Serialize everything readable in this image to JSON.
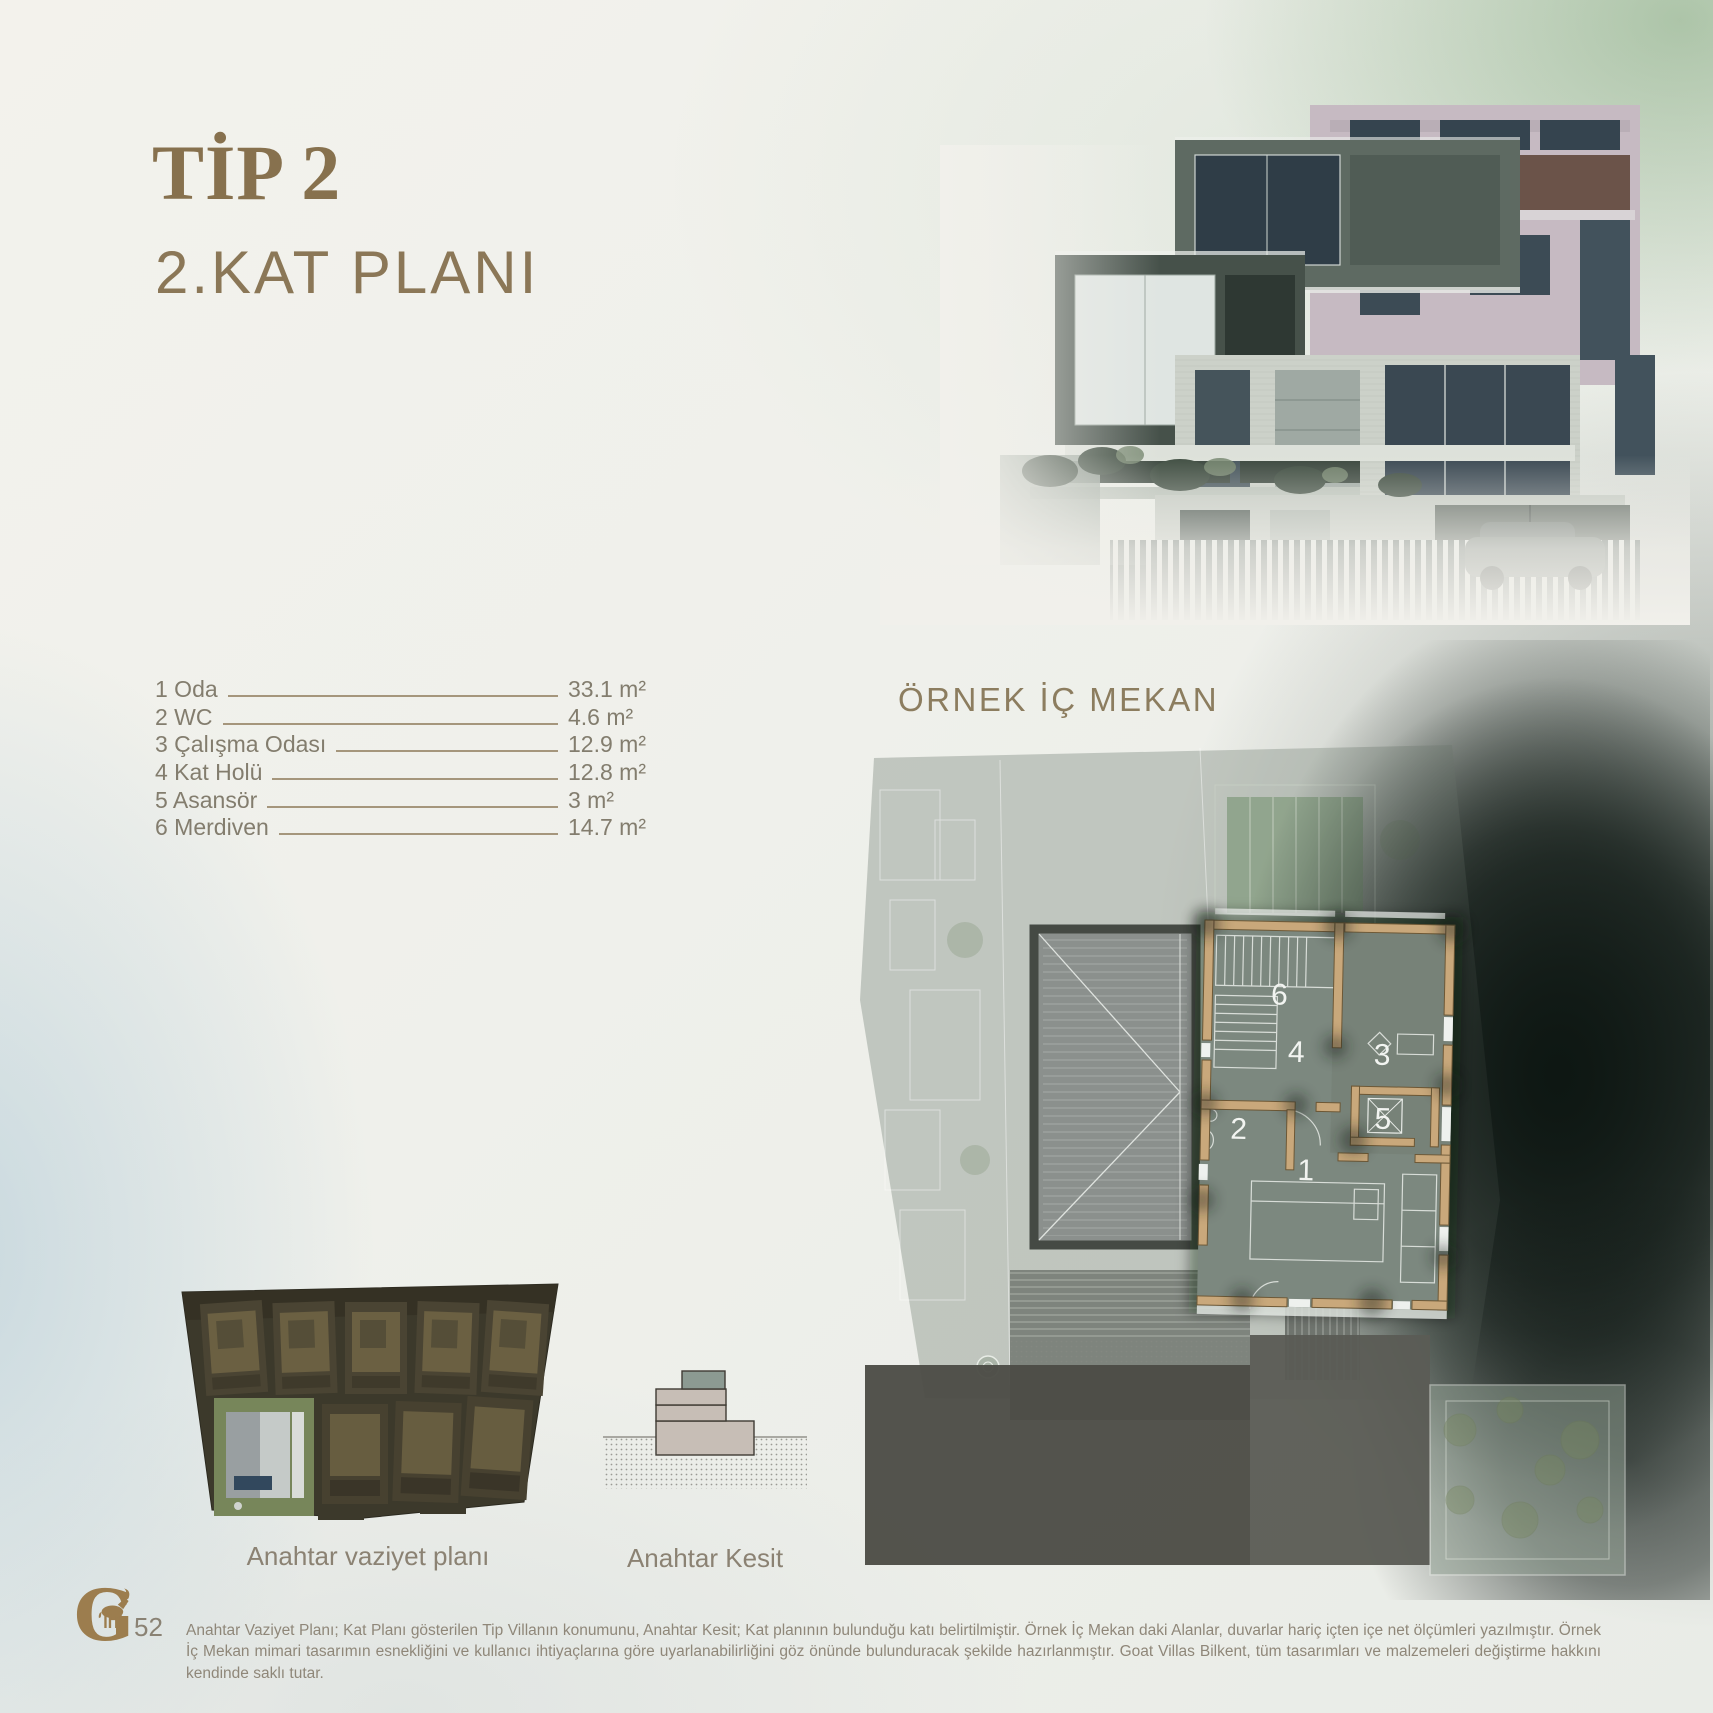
{
  "header": {
    "title": "TİP 2",
    "subtitle": "2.KAT PLANI"
  },
  "interior": {
    "heading": "ÖRNEK İÇ MEKAN"
  },
  "rooms": {
    "rows": [
      {
        "label": "1 Oda",
        "area": "33.1 m²"
      },
      {
        "label": "2 WC",
        "area": "4.6 m²"
      },
      {
        "label": "3 Çalışma Odası",
        "area": "12.9 m²"
      },
      {
        "label": "4 Kat Holü",
        "area": "12.8 m²"
      },
      {
        "label": "5 Asansör",
        "area": "3 m²"
      },
      {
        "label": "6 Merdiven",
        "area": "14.7 m²"
      }
    ]
  },
  "plan": {
    "numbers": [
      "1",
      "2",
      "3",
      "4",
      "5",
      "6"
    ]
  },
  "captions": {
    "site_plan": "Anahtar vaziyet planı",
    "section": "Anahtar Kesit"
  },
  "footer": {
    "page_number": "52",
    "disclaimer": "Anahtar Vaziyet Planı; Kat Planı gösterilen Tip Villanın konumunu, Anahtar Kesit; Kat planının bulunduğu katı belirtilmiştir. Örnek İç Mekan daki Alanlar, duvarlar hariç içten içe net ölçümleri yazılmıştır. Örnek İç Mekan mimari tasarımın esnekliğini ve kullanıcı ihtiyaçlarına göre uyarlanabilirliğini göz önünde bulunduracak şekilde hazırlanmıştır. Goat Villas Bilkent, tüm tasarımları ve malzemeleri değiştirme hakkını kendinde saklı tutar."
  },
  "colors": {
    "accent_gold": "#87714E",
    "muted_text": "#837D6E",
    "plan_wall_tan": "#C9A87B",
    "plan_floor": "#7C887F",
    "section_highlight": "#8C9A92",
    "section_beige": "#C7BEB6"
  }
}
